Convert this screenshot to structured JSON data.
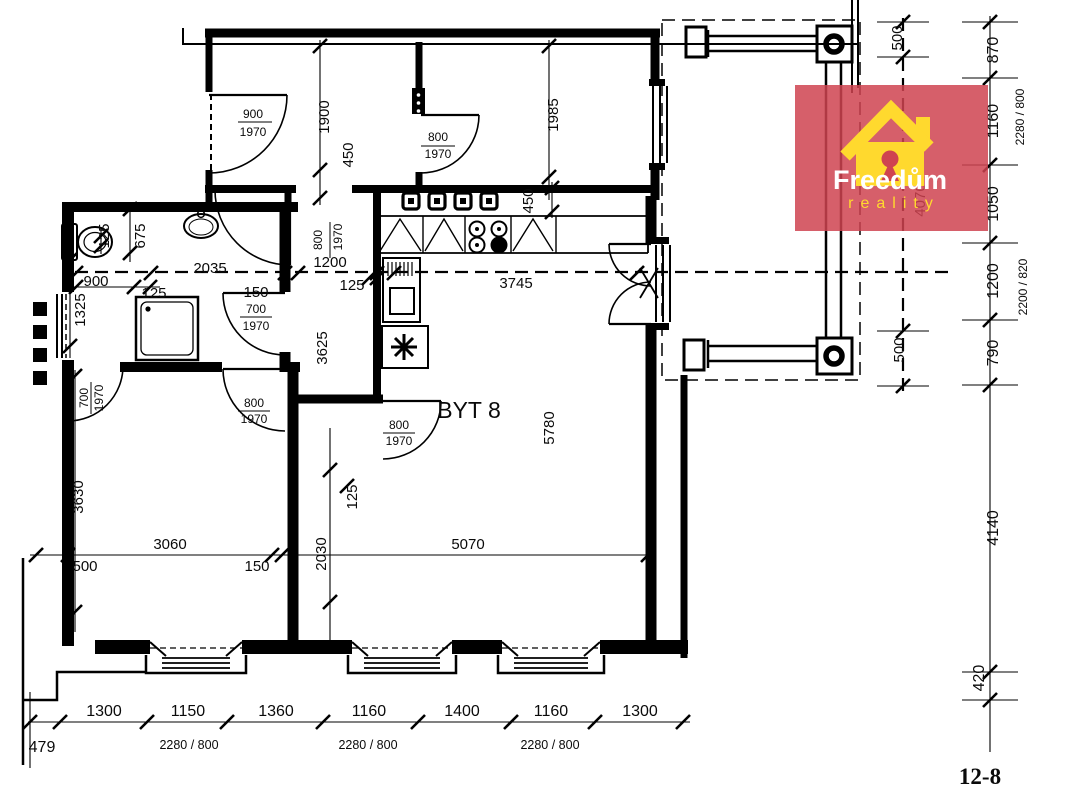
{
  "room_label": "BYT 8",
  "sheet_number": "12-8",
  "logo": {
    "brand": "Freedům",
    "tagline": "reality"
  },
  "colors": {
    "logo_red": "#cf4350",
    "logo_yellow": "#ffd92e",
    "line": "#000000"
  },
  "doors": {
    "entry": {
      "w": "900",
      "h": "1970"
    },
    "hall": {
      "w": "800",
      "h": "1970"
    },
    "corridor": {
      "w": "800",
      "h": "1970"
    },
    "bathroom": {
      "w": "700",
      "h": "1970"
    },
    "living": {
      "w": "800",
      "h": "1970"
    },
    "bedroom_left": {
      "w": "700",
      "h": "1970"
    },
    "bedroom_right": {
      "w": "800",
      "h": "1970"
    }
  },
  "dims": {
    "hall_depth": "1900",
    "hall_niche": "450",
    "room2_depth": "1985",
    "counter_depth": "450",
    "wc_width": "125",
    "wc_depth": "675",
    "left_window": "900",
    "left_pier": "1325",
    "bath_width": "2035",
    "bath_wall": "125",
    "bath_door_offset": "150",
    "corridor_width": "1200",
    "corridor_wall": "125",
    "kitchen_span": "3745",
    "corridor_length": "3625",
    "living_depth": "5780",
    "bedroom_depth": "3630",
    "partition_length": "2030",
    "partition_wall": "125",
    "bedroom_width": "3060",
    "bedroom_offset": "500",
    "partition_thickness": "150",
    "living_width": "5070"
  },
  "bottom_chain": {
    "offset": "479",
    "segments": [
      "1300",
      "1150",
      "1360",
      "1160",
      "1400",
      "1160",
      "1300"
    ],
    "window_notes": [
      "2280 / 800",
      "2280 / 800",
      "2280 / 800"
    ]
  },
  "right_chain": {
    "segments": [
      "870",
      "1160",
      "1050",
      "1200",
      "790",
      "4140",
      "420"
    ],
    "window_note_top": "2280 / 800",
    "window_note_mid": "2200 / 820"
  },
  "balcony_chain": {
    "segments": [
      "500",
      "4070",
      "500"
    ]
  }
}
